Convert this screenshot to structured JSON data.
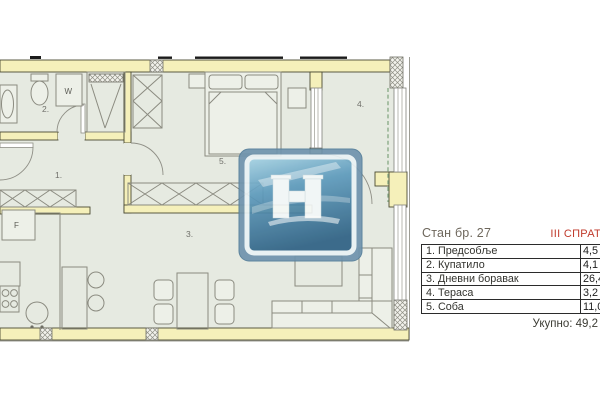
{
  "legend": {
    "apartment_title": "Стан бр. 27",
    "floor_tag": "III СПРАТ",
    "rows": [
      {
        "label": "1. Предсобље",
        "area": "4,5"
      },
      {
        "label": "2. Купатило",
        "area": "4,1"
      },
      {
        "label": "3. Дневни боравак",
        "area": "26,4"
      },
      {
        "label": "4. Тераса",
        "area": "3,2"
      },
      {
        "label": "5. Соба",
        "area": "11,0"
      }
    ],
    "total_text": "Укупно: 49,2"
  },
  "plan": {
    "room_labels": {
      "hallway": "1.",
      "bathroom": "2.",
      "living_room": "3.",
      "terrace": "4.",
      "bedroom": "5."
    },
    "fixture_labels": {
      "washing_machine": "W",
      "fridge": "F"
    },
    "colors": {
      "wall_fill": "#f5f0ba",
      "wall_stroke": "#4a4a33",
      "floor": "#e6eae1",
      "furniture_stroke": "#8b8b80",
      "terrace_railing_dash": "#86a883",
      "watermark_blue": "#6f93ad",
      "floor_tag_red": "#c03a2b"
    }
  }
}
